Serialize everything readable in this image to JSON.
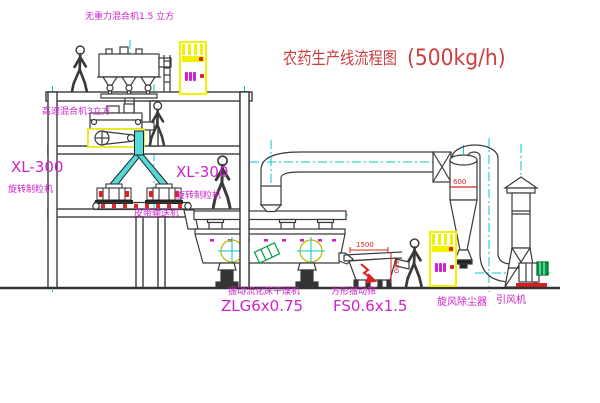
{
  "title": {
    "main": "农药生产线流程图",
    "capacity": "(500kg/h)"
  },
  "labels": {
    "mixer_top": "无重力混合机1.5 立方",
    "mixer_2f": "高速混合机3立方",
    "granulator_left_model": "XL-300",
    "granulator_left_name": "旋转制粒机",
    "granulator_right_model": "XL-300",
    "granulator_right_name": "旋转制粒机",
    "belt_conveyor": "皮带输送机",
    "dryer_name": "振动流化床干燥机",
    "dryer_model": "ZLG6x0.75",
    "sieve_name": "方形振动筛",
    "sieve_model": "FS0.6x1.5",
    "cyclone": "旋风除尘器",
    "fan": "引风机"
  },
  "dimensions": {
    "sieve_width": "1500",
    "sieve_height": "600",
    "cyclone_dia": "600"
  },
  "icons": {
    "control_cabinet": "yellow panel with indicator lights and red buttons",
    "person": "walking worker outline",
    "vibrator_symbol": "circle with crosshair"
  },
  "colors": {
    "label_magenta": "#cc22cc",
    "title_red": "#cc4040",
    "dimension_red": "#e02020",
    "cabinet_yellow": "#f2f200",
    "centerline_cyan": "#00c8c8",
    "pipe_cyan_fill": "#55d8d8",
    "motor_green": "#00a040",
    "line_dark": "#3a3a3a"
  }
}
